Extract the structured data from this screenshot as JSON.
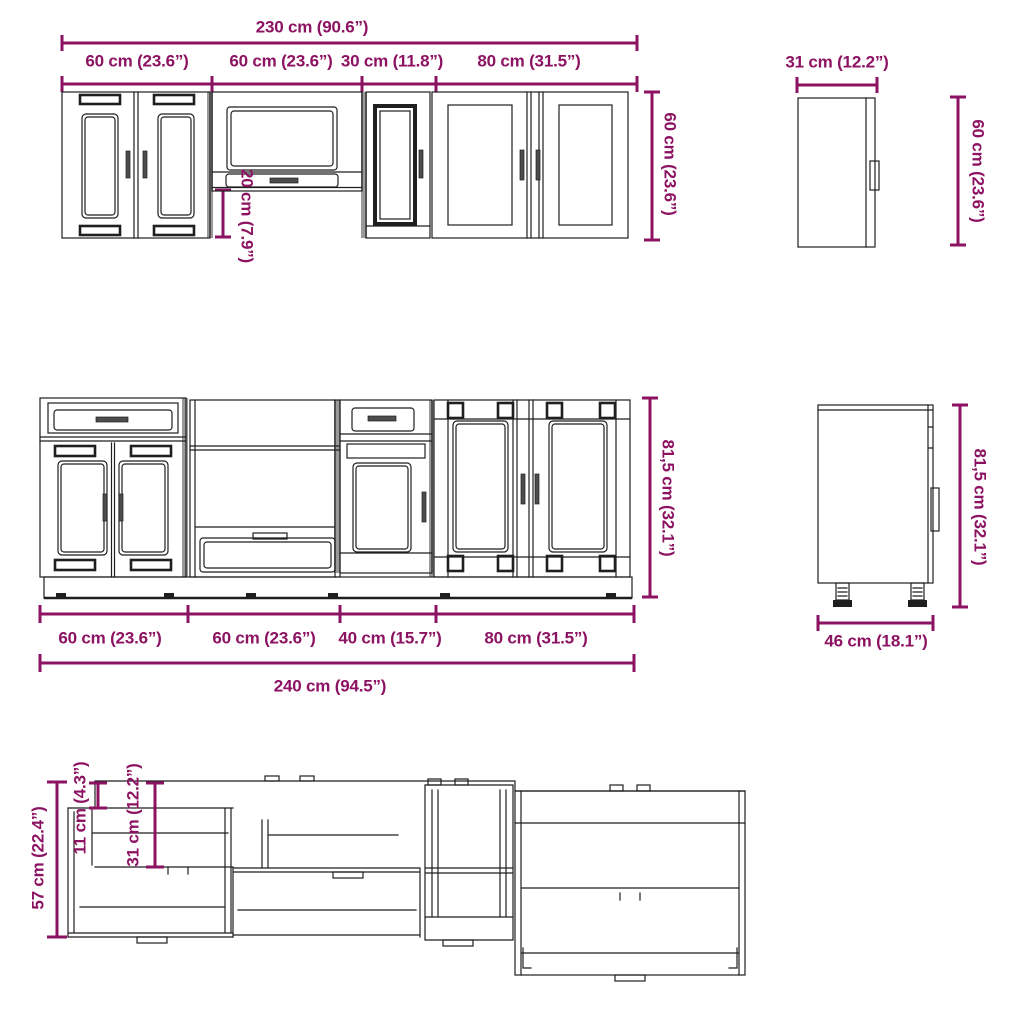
{
  "colors": {
    "dimension": "#8C1262",
    "line": "#1f1f1f"
  },
  "wall_run": {
    "total_width": "230 cm (90.6”)",
    "segments": [
      "60 cm (23.6”)",
      "60 cm (23.6”)",
      "30 cm (11.8”)",
      "80 cm (31.5”)"
    ],
    "height": "60 cm (23.6”)",
    "underhang": "20 cm (7.9”)"
  },
  "wall_side": {
    "depth": "31 cm (12.2”)",
    "height": "60 cm (23.6”)"
  },
  "base_run": {
    "segments": [
      "60 cm (23.6”)",
      "60 cm (23.6”)",
      "40 cm (15.7”)",
      "80 cm (31.5”)"
    ],
    "total_width": "240 cm (94.5”)",
    "height": "81,5 cm (32.1”)"
  },
  "base_side": {
    "depth": "46 cm (18.1”)",
    "height": "81,5 cm (32.1”)"
  },
  "perspective": {
    "height": "57 cm (22.4”)",
    "back_rail": "11 cm (4.3”)",
    "opening_depth": "31 cm (12.2”)"
  }
}
